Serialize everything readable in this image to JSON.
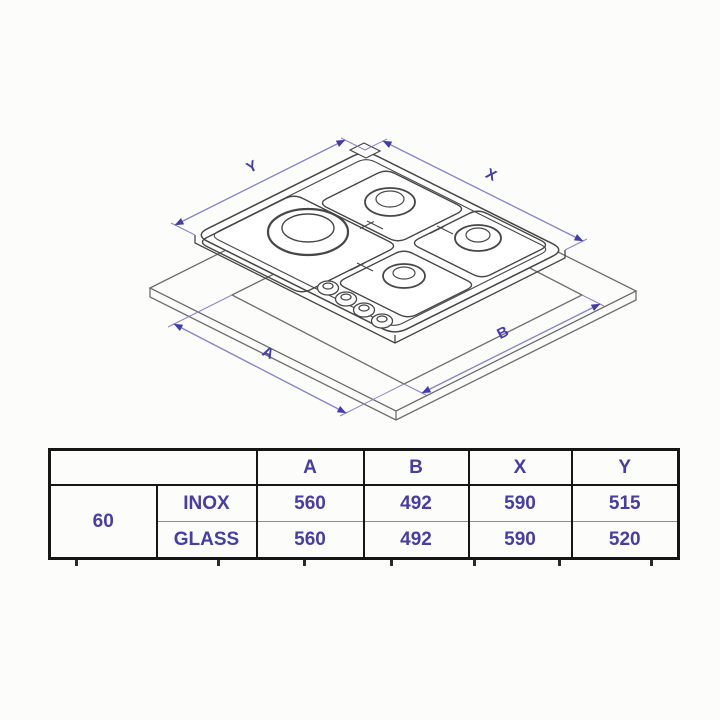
{
  "diagram": {
    "labels": {
      "y": "Y",
      "x": "X",
      "a": "A",
      "b": "B"
    },
    "dim_color": "#433cb0",
    "line_color": "#8884cc",
    "drawing_color": "#474747",
    "worktop_color": "#6e6e6e"
  },
  "table": {
    "headers": [
      "A",
      "B",
      "X",
      "Y"
    ],
    "size_label": "60",
    "rows": [
      {
        "variant": "INOX",
        "a": "560",
        "b": "492",
        "x": "590",
        "y": "515"
      },
      {
        "variant": "GLASS",
        "a": "560",
        "b": "492",
        "x": "590",
        "y": "520"
      }
    ],
    "text_color": "#473da6",
    "border_color": "#161616"
  }
}
